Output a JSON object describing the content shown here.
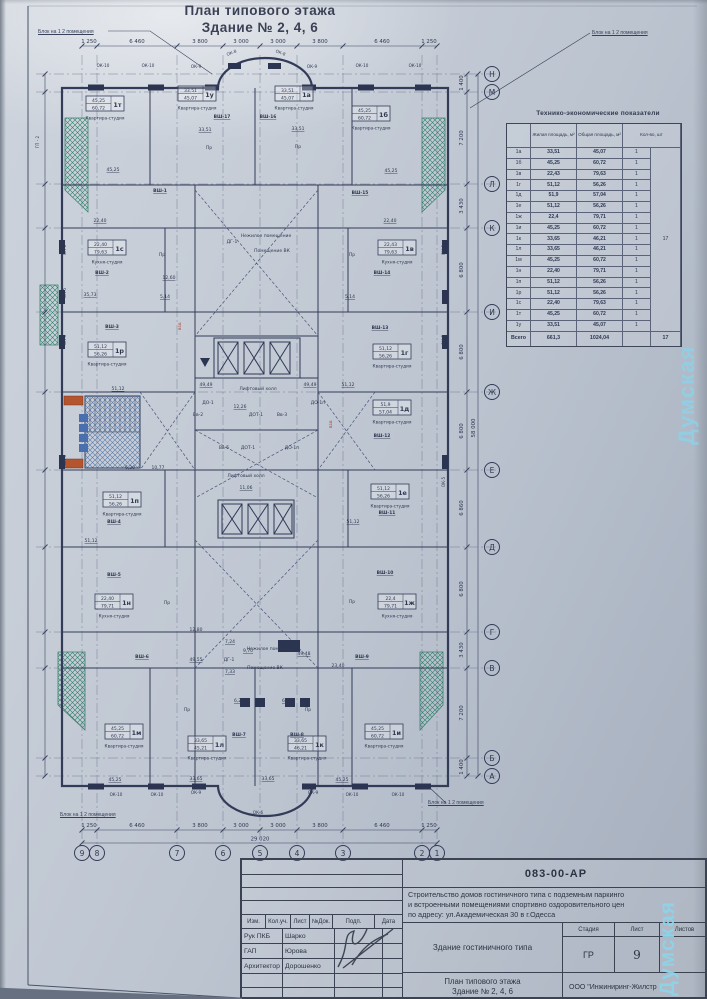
{
  "watermark": "Думская",
  "titles": {
    "line1": "План типового этажа",
    "line2": "Здание № 2, 4, 6"
  },
  "block_label": "Блок на 1  2 помещения",
  "axes": {
    "cols": [
      {
        "label": "9",
        "x": 82
      },
      {
        "label": "8",
        "x": 97
      },
      {
        "label": "7",
        "x": 177
      },
      {
        "label": "6",
        "x": 223
      },
      {
        "label": "5",
        "x": 260
      },
      {
        "label": "4",
        "x": 297
      },
      {
        "label": "3",
        "x": 343
      },
      {
        "label": "2",
        "x": 422
      },
      {
        "label": "1",
        "x": 437
      }
    ],
    "rows": [
      {
        "label": "Н",
        "y": 74
      },
      {
        "label": "М",
        "y": 92
      },
      {
        "label": "Л",
        "y": 184
      },
      {
        "label": "К",
        "y": 228
      },
      {
        "label": "И",
        "y": 312
      },
      {
        "label": "Ж",
        "y": 392
      },
      {
        "label": "Е",
        "y": 470
      },
      {
        "label": "Д",
        "y": 547
      },
      {
        "label": "Г",
        "y": 632
      },
      {
        "label": "В",
        "y": 668
      },
      {
        "label": "Б",
        "y": 758
      },
      {
        "label": "А",
        "y": 776
      }
    ],
    "h_dims": [
      {
        "v": "1 250",
        "x": 89
      },
      {
        "v": "6 460",
        "x": 137
      },
      {
        "v": "3 800",
        "x": 200
      },
      {
        "v": "3 000",
        "x": 241
      },
      {
        "v": "3 000",
        "x": 278
      },
      {
        "v": "3 800",
        "x": 320
      },
      {
        "v": "6 460",
        "x": 382
      },
      {
        "v": "1 250",
        "x": 429
      }
    ],
    "h_total": "29 020",
    "v_dims": [
      {
        "v": "1 400",
        "y": 83
      },
      {
        "v": "7 200",
        "y": 138
      },
      {
        "v": "3 430",
        "y": 206
      },
      {
        "v": "6 800",
        "y": 270
      },
      {
        "v": "6 800",
        "y": 352
      },
      {
        "v": "6 800",
        "y": 431
      },
      {
        "v": "6 860",
        "y": 508
      },
      {
        "v": "6 800",
        "y": 589
      },
      {
        "v": "3 430",
        "y": 650
      },
      {
        "v": "7 200",
        "y": 713
      },
      {
        "v": "1 400",
        "y": 767
      }
    ],
    "v_total": "58 000"
  },
  "plan": {
    "block_labels": [
      {
        "x": 38,
        "y": 29
      },
      {
        "x": 592,
        "y": 30
      },
      {
        "x": 60,
        "y": 812
      },
      {
        "x": 428,
        "y": 800
      }
    ],
    "apartments": [
      {
        "c": "1т",
        "a1": "45,25",
        "a2": "60,72",
        "ty": "Квартира-студия",
        "x": 86,
        "y": 96
      },
      {
        "c": "1у",
        "a1": "33,51",
        "a2": "45,07",
        "ty": "Квартира-студия",
        "x": 178,
        "y": 86
      },
      {
        "c": "1а",
        "a1": "33,51",
        "a2": "45,07",
        "ty": "Квартира-студия",
        "x": 275,
        "y": 86
      },
      {
        "c": "1б",
        "a1": "45,25",
        "a2": "60,72",
        "ty": "Квартира-студия",
        "x": 352,
        "y": 106
      },
      {
        "c": "1с",
        "a1": "22,40",
        "a2": "79,63",
        "ty": "Кухня-студия",
        "x": 88,
        "y": 240
      },
      {
        "c": "1в",
        "a1": "22,43",
        "a2": "79,63",
        "ty": "Кухня-студия",
        "x": 378,
        "y": 240
      },
      {
        "c": "1р",
        "a1": "51,12",
        "a2": "56,26",
        "ty": "Квартира-студия",
        "x": 88,
        "y": 342
      },
      {
        "c": "1г",
        "a1": "51,12",
        "a2": "56,26",
        "ty": "Квартира-студия",
        "x": 373,
        "y": 344
      },
      {
        "c": "1д",
        "a1": "51,9",
        "a2": "57,04",
        "ty": "Квартира-студия",
        "x": 373,
        "y": 400
      },
      {
        "c": "1п",
        "a1": "51,12",
        "a2": "56,26",
        "ty": "Квартира-студия",
        "x": 103,
        "y": 492
      },
      {
        "c": "1е",
        "a1": "51,12",
        "a2": "56,26",
        "ty": "Квартира-студия",
        "x": 371,
        "y": 484
      },
      {
        "c": "1н",
        "a1": "22,40",
        "a2": "79,71",
        "ty": "Кухня-студия",
        "x": 95,
        "y": 594
      },
      {
        "c": "1ж",
        "a1": "22,4",
        "a2": "79,71",
        "ty": "Кухня-студия",
        "x": 378,
        "y": 594
      },
      {
        "c": "1м",
        "a1": "45,25",
        "a2": "60,72",
        "ty": "Квартира-студия",
        "x": 105,
        "y": 724
      },
      {
        "c": "1л",
        "a1": "33,65",
        "a2": "45,21",
        "ty": "Квартира-студия",
        "x": 188,
        "y": 736
      },
      {
        "c": "1к",
        "a1": "33,65",
        "a2": "46,21",
        "ty": "Квартира-студия",
        "x": 288,
        "y": 736
      },
      {
        "c": "1и",
        "a1": "45,25",
        "a2": "60,72",
        "ty": "Квартира-студия",
        "x": 365,
        "y": 724
      }
    ],
    "shafts": [
      {
        "t": "ВШ-17",
        "x": 222,
        "y": 118
      },
      {
        "t": "ВШ-16",
        "x": 268,
        "y": 118
      },
      {
        "t": "ВШ-1",
        "x": 160,
        "y": 192
      },
      {
        "t": "ВШ-15",
        "x": 360,
        "y": 194
      },
      {
        "t": "ВШ-2",
        "x": 102,
        "y": 274
      },
      {
        "t": "ВШ-14",
        "x": 382,
        "y": 274
      },
      {
        "t": "ВШ-3",
        "x": 112,
        "y": 328
      },
      {
        "t": "ВШ-13",
        "x": 380,
        "y": 329
      },
      {
        "t": "ВШ-12",
        "x": 382,
        "y": 437
      },
      {
        "t": "ВШ-4",
        "x": 114,
        "y": 523
      },
      {
        "t": "ВШ-11",
        "x": 387,
        "y": 514
      },
      {
        "t": "ВШ-5",
        "x": 114,
        "y": 576
      },
      {
        "t": "ВШ-10",
        "x": 385,
        "y": 574
      },
      {
        "t": "ВШ-6",
        "x": 142,
        "y": 658
      },
      {
        "t": "ВШ-9",
        "x": 362,
        "y": 658
      },
      {
        "t": "ВШ-7",
        "x": 239,
        "y": 736
      },
      {
        "t": "ВШ-8",
        "x": 297,
        "y": 736
      }
    ],
    "rooms": [
      {
        "t": "Лифтовый холл",
        "x": 258,
        "y": 390
      },
      {
        "t": "Лифтовый холл",
        "x": 246,
        "y": 477
      },
      {
        "t": "Нежилое помещение",
        "x": 266,
        "y": 237
      },
      {
        "t": "Помещение ВК",
        "x": 272,
        "y": 252
      },
      {
        "t": "Нежилое помещение",
        "x": 272,
        "y": 650
      },
      {
        "t": "Помещение ВК",
        "x": 265,
        "y": 669
      },
      {
        "t": "ДГ-1",
        "x": 232,
        "y": 243
      },
      {
        "t": "ДГ-1",
        "x": 229,
        "y": 661
      },
      {
        "t": "ДО-1",
        "x": 208,
        "y": 404
      },
      {
        "t": "ДО-1п",
        "x": 318,
        "y": 404
      },
      {
        "t": "Вв-2",
        "x": 198,
        "y": 416
      },
      {
        "t": "ДОТ-1",
        "x": 256,
        "y": 416
      },
      {
        "t": "Вв-3",
        "x": 282,
        "y": 416
      },
      {
        "t": "Вв-5",
        "x": 224,
        "y": 449
      },
      {
        "t": "ДОТ-1",
        "x": 248,
        "y": 449
      },
      {
        "t": "ДО-1п",
        "x": 292,
        "y": 449
      },
      {
        "t": "Пр",
        "x": 209,
        "y": 149
      },
      {
        "t": "Пр",
        "x": 298,
        "y": 148
      },
      {
        "t": "Пр",
        "x": 162,
        "y": 256
      },
      {
        "t": "Пр",
        "x": 352,
        "y": 256
      },
      {
        "t": "Пр",
        "x": 167,
        "y": 604
      },
      {
        "t": "Пр",
        "x": 352,
        "y": 603
      },
      {
        "t": "Пр",
        "x": 187,
        "y": 711
      },
      {
        "t": "Пр",
        "x": 308,
        "y": 711
      }
    ],
    "numbers": [
      {
        "t": "45,25",
        "x": 113,
        "y": 171
      },
      {
        "t": "33,51",
        "x": 205,
        "y": 131
      },
      {
        "t": "33,51",
        "x": 298,
        "y": 130
      },
      {
        "t": "45,25",
        "x": 391,
        "y": 172
      },
      {
        "t": "22,40",
        "x": 100,
        "y": 222
      },
      {
        "t": "22,40",
        "x": 390,
        "y": 222
      },
      {
        "t": "35,73",
        "x": 90,
        "y": 296
      },
      {
        "t": "12,60",
        "x": 169,
        "y": 279
      },
      {
        "t": "5,14",
        "x": 165,
        "y": 298
      },
      {
        "t": "5,14",
        "x": 350,
        "y": 298
      },
      {
        "t": "51,12",
        "x": 118,
        "y": 390
      },
      {
        "t": "51,12",
        "x": 348,
        "y": 386
      },
      {
        "t": "49,49",
        "x": 206,
        "y": 386
      },
      {
        "t": "49,49",
        "x": 310,
        "y": 386
      },
      {
        "t": "12,26",
        "x": 240,
        "y": 408
      },
      {
        "t": "10,77",
        "x": 158,
        "y": 469
      },
      {
        "t": "6,20",
        "x": 130,
        "y": 469
      },
      {
        "t": "11,06",
        "x": 246,
        "y": 489
      },
      {
        "t": "51,12",
        "x": 91,
        "y": 542
      },
      {
        "t": "51,12",
        "x": 353,
        "y": 523
      },
      {
        "t": "12,80",
        "x": 196,
        "y": 631
      },
      {
        "t": "9,70",
        "x": 248,
        "y": 652
      },
      {
        "t": "7,24",
        "x": 230,
        "y": 643
      },
      {
        "t": "7,33",
        "x": 230,
        "y": 673
      },
      {
        "t": "49,55",
        "x": 196,
        "y": 661
      },
      {
        "t": "49,48",
        "x": 304,
        "y": 655
      },
      {
        "t": "23,40",
        "x": 338,
        "y": 667
      },
      {
        "t": "6,22",
        "x": 239,
        "y": 702
      },
      {
        "t": "6,22",
        "x": 287,
        "y": 702
      },
      {
        "t": "45,25",
        "x": 115,
        "y": 781
      },
      {
        "t": "33,65",
        "x": 196,
        "y": 780
      },
      {
        "t": "33,65",
        "x": 268,
        "y": 780
      },
      {
        "t": "45,25",
        "x": 342,
        "y": 781
      }
    ],
    "windows": [
      {
        "t": "ОК-10",
        "x": 103,
        "y": 67
      },
      {
        "t": "ОК-10",
        "x": 148,
        "y": 67
      },
      {
        "t": "ОК-9",
        "x": 196,
        "y": 68
      },
      {
        "t": "ОК-8",
        "x": 232,
        "y": 54,
        "r": -22
      },
      {
        "t": "ОК-8",
        "x": 280,
        "y": 54,
        "r": 22
      },
      {
        "t": "ОК-9",
        "x": 312,
        "y": 68
      },
      {
        "t": "ОК-10",
        "x": 362,
        "y": 67
      },
      {
        "t": "ОК-10",
        "x": 415,
        "y": 67
      },
      {
        "t": "ОК-10",
        "x": 116,
        "y": 796
      },
      {
        "t": "ОК-10",
        "x": 157,
        "y": 796
      },
      {
        "t": "ОК-9",
        "x": 196,
        "y": 794
      },
      {
        "t": "ОК-6",
        "x": 258,
        "y": 814
      },
      {
        "t": "ОК-9",
        "x": 313,
        "y": 794
      },
      {
        "t": "ОК-10",
        "x": 352,
        "y": 796
      },
      {
        "t": "ОК-10",
        "x": 398,
        "y": 796
      },
      {
        "t": "ОК-6",
        "x": 66,
        "y": 250,
        "r": -90
      },
      {
        "t": "ОК-5",
        "x": 66,
        "y": 293,
        "r": -90
      },
      {
        "t": "ОК-5",
        "x": 66,
        "y": 340,
        "r": -90
      },
      {
        "t": "ОК-5",
        "x": 66,
        "y": 460,
        "r": -90
      },
      {
        "t": "ОК-5",
        "x": 445,
        "y": 250,
        "r": -90
      },
      {
        "t": "ОК-5",
        "x": 445,
        "y": 340,
        "r": -90
      },
      {
        "t": "ОК-5",
        "x": 445,
        "y": 482,
        "r": -90
      },
      {
        "t": "ГП - 2",
        "x": 39,
        "y": 142,
        "r": -90
      }
    ]
  },
  "teo": {
    "title": "Технико-экономические показатели",
    "col_headers": {
      "living": "Жилая площадь, м²",
      "total": "Общая площадь, м²",
      "count": "Кол-во, шт"
    },
    "rows": [
      [
        "1а",
        "33,51",
        "45,07",
        "1"
      ],
      [
        "1б",
        "45,25",
        "60,72",
        "1"
      ],
      [
        "1в",
        "22,43",
        "79,63",
        "1"
      ],
      [
        "1г",
        "51,12",
        "56,26",
        "1"
      ],
      [
        "1д",
        "51,9",
        "57,04",
        "1"
      ],
      [
        "1е",
        "51,12",
        "56,26",
        "1"
      ],
      [
        "1ж",
        "22,4",
        "79,71",
        "1"
      ],
      [
        "1и",
        "45,25",
        "60,72",
        "1"
      ],
      [
        "1к",
        "33,65",
        "46,21",
        "1"
      ],
      [
        "1л",
        "33,65",
        "46,21",
        "1"
      ],
      [
        "1м",
        "45,25",
        "60,72",
        "1"
      ],
      [
        "1н",
        "22,40",
        "79,71",
        "1"
      ],
      [
        "1п",
        "51,12",
        "56,26",
        "1"
      ],
      [
        "1р",
        "51,12",
        "56,26",
        "1"
      ],
      [
        "1с",
        "22,40",
        "79,63",
        "1"
      ],
      [
        "1т",
        "45,25",
        "60,72",
        "1"
      ],
      [
        "1у",
        "33,51",
        "45,07",
        "1"
      ]
    ],
    "merged_count": "17",
    "footer": {
      "label": "Всего",
      "living": "661,3",
      "total": "1024,04",
      "count": "17"
    }
  },
  "titleblock": {
    "code": "083-00-АР",
    "project": [
      "Строительство  домов гостиничного типа с подземным паркинго",
      "и встроенными помещениями спортивно оздоровительного цен",
      "по адресу:  ул.Академическая 30 в г.Одесса"
    ],
    "cols": [
      "Изм.",
      "Кол.уч.",
      "Лист",
      "№Док.",
      "Подп.",
      "Дата"
    ],
    "roles": [
      {
        "role": "Рук ПКБ",
        "name": "Шарко"
      },
      {
        "role": "ГАП",
        "name": "Юрова"
      },
      {
        "role": "Архитектор",
        "name": "Дорошенко"
      }
    ],
    "doc_title": "Здание гостиничного типа",
    "stage_label": "Стадия",
    "sheet_label": "Лист",
    "sheets_label": "Листов",
    "stage": "ГР",
    "sheet_no": "9",
    "plan_title1": "План типового этажа",
    "plan_title2": "Здание № 2, 4, 6",
    "company": "ООО \"Инжиниринг-Жилстр"
  }
}
